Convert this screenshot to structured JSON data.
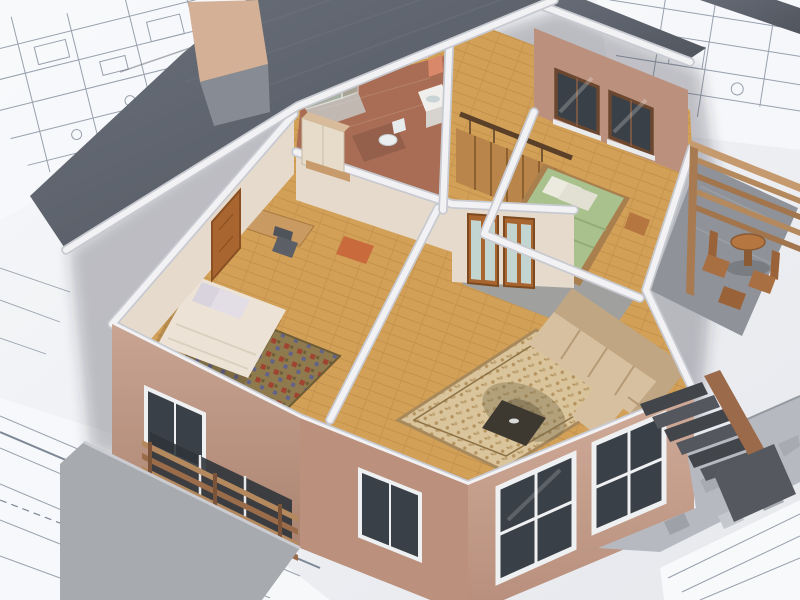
{
  "scene": {
    "title": "3D architectural cutaway rendering of a house upper floor, viewed from above, standing on technical blueprint drawings",
    "view": "isometric doll-house cutaway",
    "rooms": [
      "bathroom",
      "staircase hall",
      "bedroom with green bed",
      "balcony terrace",
      "bedroom with double bed",
      "living room"
    ],
    "objects": [
      "glass shower",
      "vanity with mirror",
      "toilet",
      "interior staircase",
      "green double bed",
      "balcony table and chairs",
      "wood slat railing",
      "double bed with pillows",
      "ornate olive carpet",
      "desk and chair",
      "wardrobe",
      "wooden door",
      "french doors",
      "sectional sofa",
      "coffee table",
      "ornate beige carpet",
      "exterior staircase",
      "paved path",
      "lower-floor windows",
      "wooden balcony railing",
      "blueprint floor plans"
    ]
  },
  "palette": {
    "paper": "#eef0f4",
    "paper_bright": "#f8f9fb",
    "line": "#97a0ad",
    "line_dark": "#7e8796",
    "roof": "#595f68",
    "roof_light": "#6f757f",
    "fascia": "#f2f2f4",
    "band_edge": "#c8cad1",
    "wall_tan": "#bb917e",
    "wall_tan_light": "#cfa894",
    "wall_tan_dark": "#a37f6c",
    "wall_cream": "#e5dacb",
    "wood_floor": "#d2a057",
    "wood_dark": "#b9823f",
    "terracotta": "#a86d54",
    "glass_aqua": "#a7d1cd",
    "glass_dark": "#3a4047",
    "frame_white": "#eef0f2",
    "door_wood": "#a8652f",
    "furniture_wood": "#b5763f",
    "bed_cream": "#ece3d6",
    "pillow": "#d8d3dc",
    "bed_green": "#a9c18d",
    "carpet_olive": "#8e7a4d",
    "carpet_red": "#a23b2c",
    "carpet_blue": "#5c5e93",
    "carpet_beige": "#d9c49c",
    "carpet_beige_dark": "#b4935f",
    "sofa": "#d7c0a0",
    "sofa_dark": "#c0a682",
    "railing_wood": "#b5895e",
    "stairs_dark": "#45484d",
    "concrete": "#a7aaaf",
    "path": "#b6b9bf",
    "shadow": "rgba(45,50,60,0.28)"
  }
}
